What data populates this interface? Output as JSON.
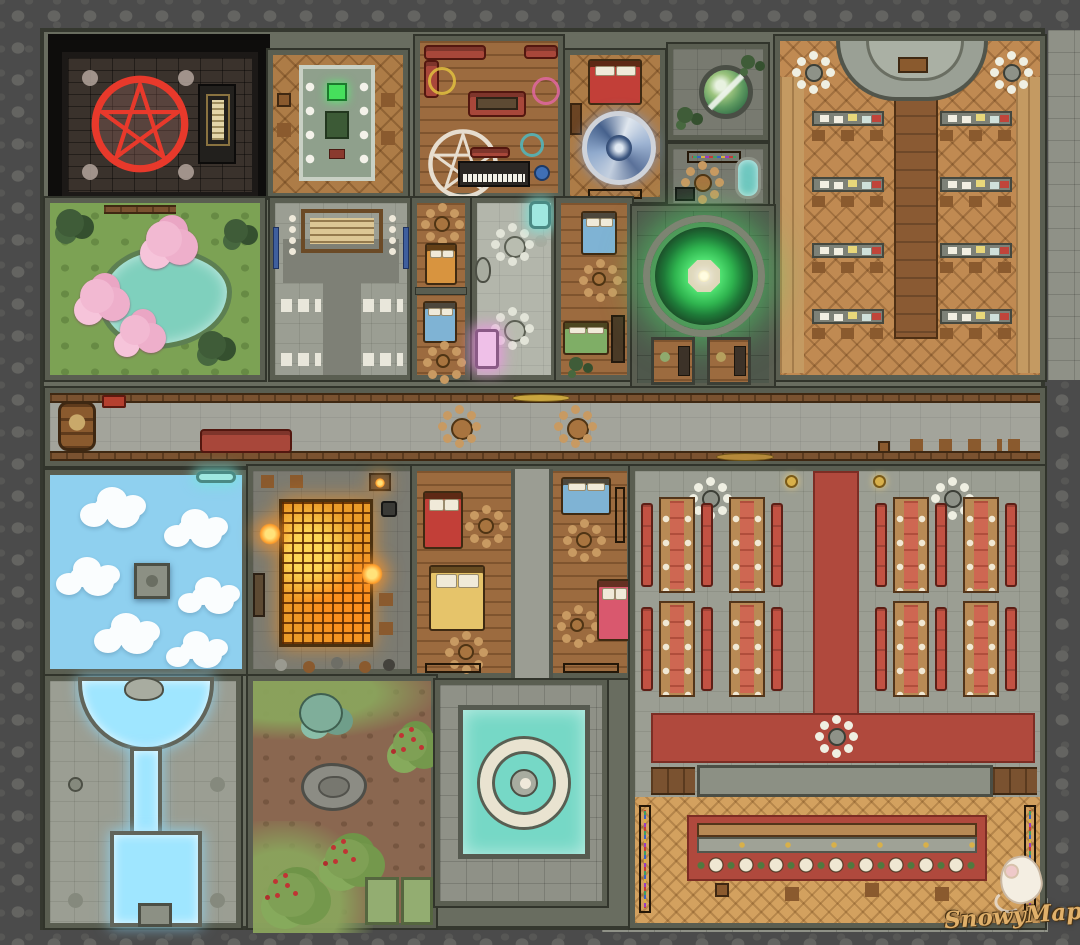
{
  "map": {
    "type": "fantasy-battle-map",
    "setting": "mage-guild-interior",
    "watermark": {
      "label": "SnowyMaps",
      "mascot": "white-mouse-icon"
    },
    "palette": {
      "cobble": "#4b4b4b",
      "flagstone": "#8f9187",
      "wall": "#696d60",
      "wall_dark": "#31342b",
      "stone_floor": "#9b9e93",
      "dark_stone": "#787a70",
      "moss_stone": "#4f584c",
      "wood": "#ad7c47",
      "wood_plank": "#9c6b3f",
      "wood_light": "#c08a52",
      "parquet": "#d3a15f",
      "wood_trim": "#7a5230",
      "void_black": "#0e0d0c",
      "brick": "#3a322c",
      "pentagram_red": "#e8392b",
      "pentagram_white": "#eee8dc",
      "grass": "#7ca254",
      "pond_teal": "#7fd0bd",
      "blossom_pink": "#f2b9d2",
      "sky_blue": "#8fd0ef",
      "cloud_white": "#ffffff",
      "portal_green": "#3fd468",
      "vortex_blue": "#8fa9cc",
      "glow_water": "#9fe6ff",
      "fountain_teal": "#76d8c6",
      "ember_orange": "#eb9b28",
      "carpet_red": "#b0493d",
      "bench_red": "#c25243",
      "runner_red": "#ce6752",
      "bed_red": "#c23f38",
      "bed_orange": "#d8943f",
      "bed_yellow": "#e6c46a",
      "bed_blue": "#7fb3d4",
      "bed_pink": "#d9586e",
      "bed_green": "#7fae66",
      "altar_pink": "#efc0e8",
      "pod_teal": "#9fe8e0"
    },
    "rooms": [
      {
        "id": "ritual-chamber",
        "features": [
          "red-pentagram-circle",
          "scroll-stand",
          "corner-candles",
          "dark-void"
        ]
      },
      {
        "id": "dining-room",
        "features": [
          "long-stone-table",
          "place-settings",
          "crates"
        ]
      },
      {
        "id": "lounge-study",
        "features": [
          "red-sofas",
          "white-pentagram-rug",
          "piano",
          "magic-circles",
          "seated-figure"
        ]
      },
      {
        "id": "portal-bedroom",
        "features": [
          "red-bed",
          "blue-vortex-portal",
          "bookshelf"
        ]
      },
      {
        "id": "globe-room",
        "features": [
          "world-globe",
          "plants"
        ]
      },
      {
        "id": "bath-lab",
        "features": [
          "potion-shelf",
          "round-table",
          "bathtub",
          "basin"
        ]
      },
      {
        "id": "lecture-hall",
        "features": [
          "semicircular-dais",
          "lectern",
          "desk-rows",
          "benches",
          "chandeliers",
          "center-aisle"
        ]
      },
      {
        "id": "blossom-garden",
        "features": [
          "pond",
          "cherry-blossom-trees",
          "bushes",
          "fence"
        ]
      },
      {
        "id": "notice-hall",
        "features": [
          "notice-board",
          "candle-stands",
          "white-benches",
          "blue-banners"
        ]
      },
      {
        "id": "small-dormitory",
        "features": [
          "orange-bed",
          "blue-bed",
          "round-tables"
        ]
      },
      {
        "id": "assembly-hall",
        "features": [
          "stool-clusters",
          "statues",
          "pink-glow-altar",
          "teal-glow-pod"
        ]
      },
      {
        "id": "dorm-cells",
        "features": [
          "blue-bed",
          "green-bed",
          "desk"
        ]
      },
      {
        "id": "teleport-chamber",
        "features": [
          "green-portal-circle",
          "study-alcoves"
        ]
      },
      {
        "id": "main-corridor",
        "features": [
          "barrel",
          "sofa",
          "round-tables",
          "benches",
          "gold-platters"
        ]
      },
      {
        "id": "sky-illusion-room",
        "features": [
          "cloud-floor",
          "floating-platform",
          "glowing-entry"
        ]
      },
      {
        "id": "forge-room",
        "features": [
          "ember-grid-floor",
          "fires",
          "anvil",
          "tool-shelves",
          "hearth"
        ]
      },
      {
        "id": "dormitory-block",
        "features": [
          "red-bed",
          "yellow-bed",
          "blue-bed",
          "pink-bed",
          "central-hallway",
          "bookshelves"
        ]
      },
      {
        "id": "water-shrine",
        "features": [
          "glowing-basin",
          "water-channel",
          "pool",
          "altar",
          "floor-medallions"
        ]
      },
      {
        "id": "courtyard-garden",
        "features": [
          "berry-bushes",
          "teal-shrub",
          "boulder",
          "garden-plots"
        ]
      },
      {
        "id": "fountain-court",
        "features": [
          "teal-pool",
          "stone-fountain-ring",
          "statue"
        ]
      },
      {
        "id": "banquet-hall",
        "features": [
          "red-carpet-aisle",
          "long-banquet-tables",
          "red-benches",
          "stage",
          "buffet-counter",
          "stools",
          "chandeliers",
          "side-shelves"
        ]
      }
    ]
  }
}
